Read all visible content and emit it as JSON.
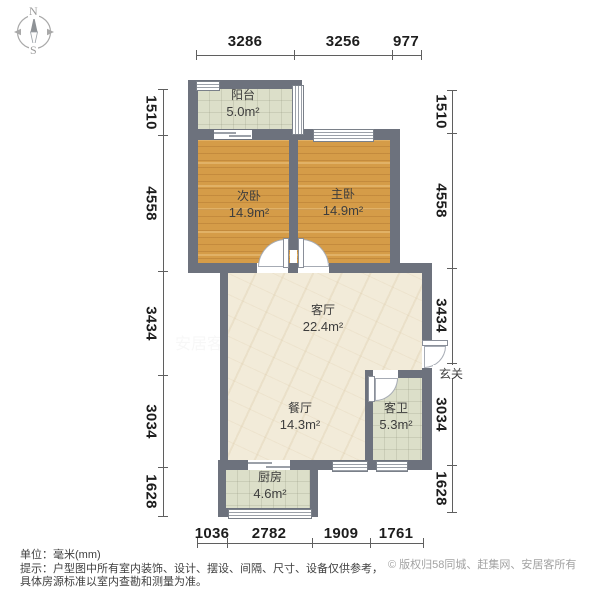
{
  "compass": {
    "north": "N",
    "south": "S"
  },
  "plan": {
    "rooms": [
      {
        "id": "balcony",
        "name": "阳台",
        "area": "5.0m²"
      },
      {
        "id": "second-bedroom",
        "name": "次卧",
        "area": "14.9m²"
      },
      {
        "id": "master-bedroom",
        "name": "主卧",
        "area": "14.9m²"
      },
      {
        "id": "living-room",
        "name": "客厅",
        "area": "22.4m²"
      },
      {
        "id": "dining-room",
        "name": "餐厅",
        "area": "14.3m²"
      },
      {
        "id": "guest-bathroom",
        "name": "客卫",
        "area": "5.3m²"
      },
      {
        "id": "kitchen",
        "name": "厨房",
        "area": "4.6m²"
      },
      {
        "id": "entry",
        "name": "玄关",
        "area": ""
      }
    ]
  },
  "dimensions": {
    "top": [
      "3286",
      "3256",
      "977"
    ],
    "left": [
      "1510",
      "4558",
      "3434",
      "3034",
      "1628"
    ],
    "right": [
      "1510",
      "4558",
      "3434",
      "3034",
      "1628"
    ],
    "bottom": [
      "1036",
      "2782",
      "1909",
      "1761"
    ]
  },
  "footer": {
    "unit": "单位：毫米(mm)",
    "tip_line1": "提示：户型图中所有室内装饰、设计、摆设、间隔、尺寸、设备仅供参考，",
    "tip_line2": "具体房源标准以室内查勘和测量为准。",
    "copyright": "© 版权归58同城、赶集网、安居客所有"
  },
  "watermark": {
    "text": "安居客"
  },
  "colors": {
    "wall": "#6d727d",
    "wood_floor": "#d59c48",
    "marble_floor": "#f2ebd9",
    "tile_floor": "#dcdfc9",
    "dimension_text": "#1d1d1d",
    "copyright_text": "#a2a2a2"
  }
}
